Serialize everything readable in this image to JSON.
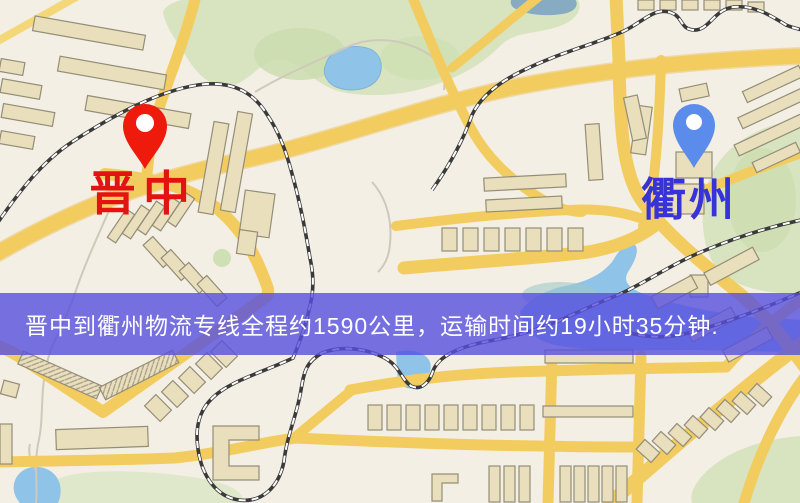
{
  "origin": {
    "city": "晋中",
    "pin_color": "#ee1a0c",
    "label_color": "#e21310"
  },
  "destination": {
    "city": "衢州",
    "pin_color": "#5b8ceb",
    "label_color": "#3733d8"
  },
  "banner": {
    "text": "晋中到衢州物流专线全程约1590公里，运输时间约19小时35分钟.",
    "background_color": "#564fde",
    "text_color": "#ffffff",
    "distance_text": "约1590公里",
    "duration_text": "约19小时35分钟"
  },
  "map_palette": {
    "background": "#f4efe4",
    "road": "#f3cc60",
    "building_fill": "#e9dfbd",
    "building_outline": "#948d77",
    "park": "#d7e4bf",
    "water": "#8fc3e8",
    "railway": "#3a3a3a",
    "railway_dash": "#ffffff"
  }
}
